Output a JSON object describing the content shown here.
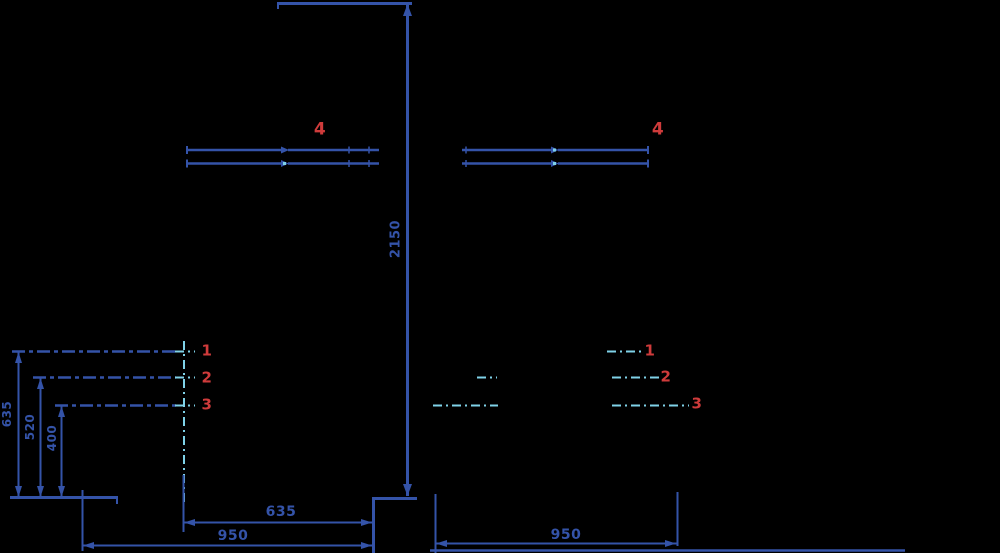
{
  "colors": {
    "background": "#000000",
    "line_blue": "#3453a8",
    "accent_cyan": "#7fd2e8",
    "label_red": "#cf3b3b"
  },
  "drawing": {
    "dimensions": {
      "overall_height": "2150",
      "left_heights": [
        "635",
        "520",
        "400"
      ],
      "bottom_left_inner": "635",
      "bottom_left_outer": "950",
      "bottom_right": "950"
    },
    "part_labels": {
      "rail_label": "4",
      "left_rows": [
        "1",
        "2",
        "3"
      ],
      "right_rows": [
        "1",
        "2",
        "3"
      ]
    }
  }
}
